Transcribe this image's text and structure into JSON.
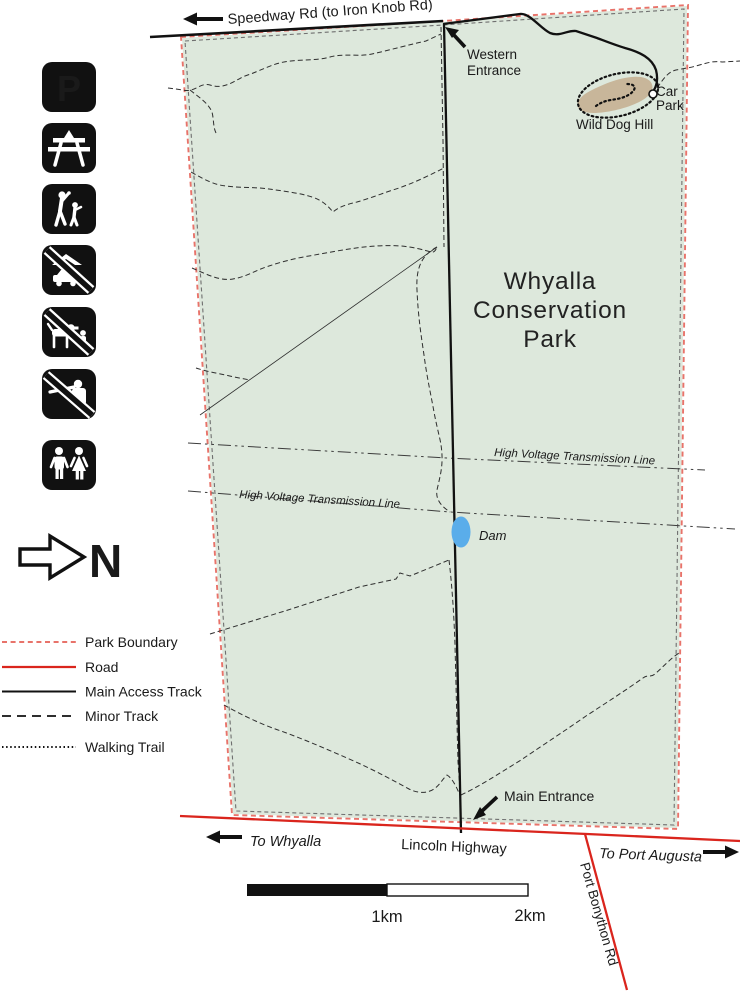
{
  "map": {
    "park_title": [
      "Whyalla",
      "Conservation",
      "Park"
    ],
    "roads": {
      "speedway": "Speedway Rd (to Iron Knob Rd)",
      "lincoln": "Lincoln Highway",
      "port_bonython": "Port Bonython Rd",
      "to_whyalla": "To Whyalla",
      "to_port_augusta": "To Port Augusta"
    },
    "features": {
      "western_entrance": [
        "Western",
        "Entrance"
      ],
      "main_entrance": "Main Entrance",
      "car_park": [
        "Car",
        "Park"
      ],
      "wild_dog_hill": "Wild Dog Hill",
      "dam": "Dam",
      "hv_line": "High Voltage Transmission Line"
    },
    "north": "N"
  },
  "icons": [
    {
      "name": "parking-icon",
      "glyph": "P"
    },
    {
      "name": "picnic-area-icon"
    },
    {
      "name": "bushwalking-icon"
    },
    {
      "name": "no-camping-icon"
    },
    {
      "name": "no-dogs-icon"
    },
    {
      "name": "no-hunting-icon"
    },
    {
      "name": "toilets-icon"
    }
  ],
  "legend": {
    "items": [
      {
        "label": "Park Boundary"
      },
      {
        "label": "Road"
      },
      {
        "label": "Main Access Track"
      },
      {
        "label": "Minor Track"
      },
      {
        "label": "Walking Trail"
      }
    ]
  },
  "scalebar": {
    "mid": "1km",
    "end": "2km"
  },
  "colors": {
    "park_fill": "#dde8dc",
    "boundary_red": "#e8736a",
    "road_red": "#da251d",
    "water_blue": "#5aadea",
    "hill_tan": "#c8b69a"
  }
}
